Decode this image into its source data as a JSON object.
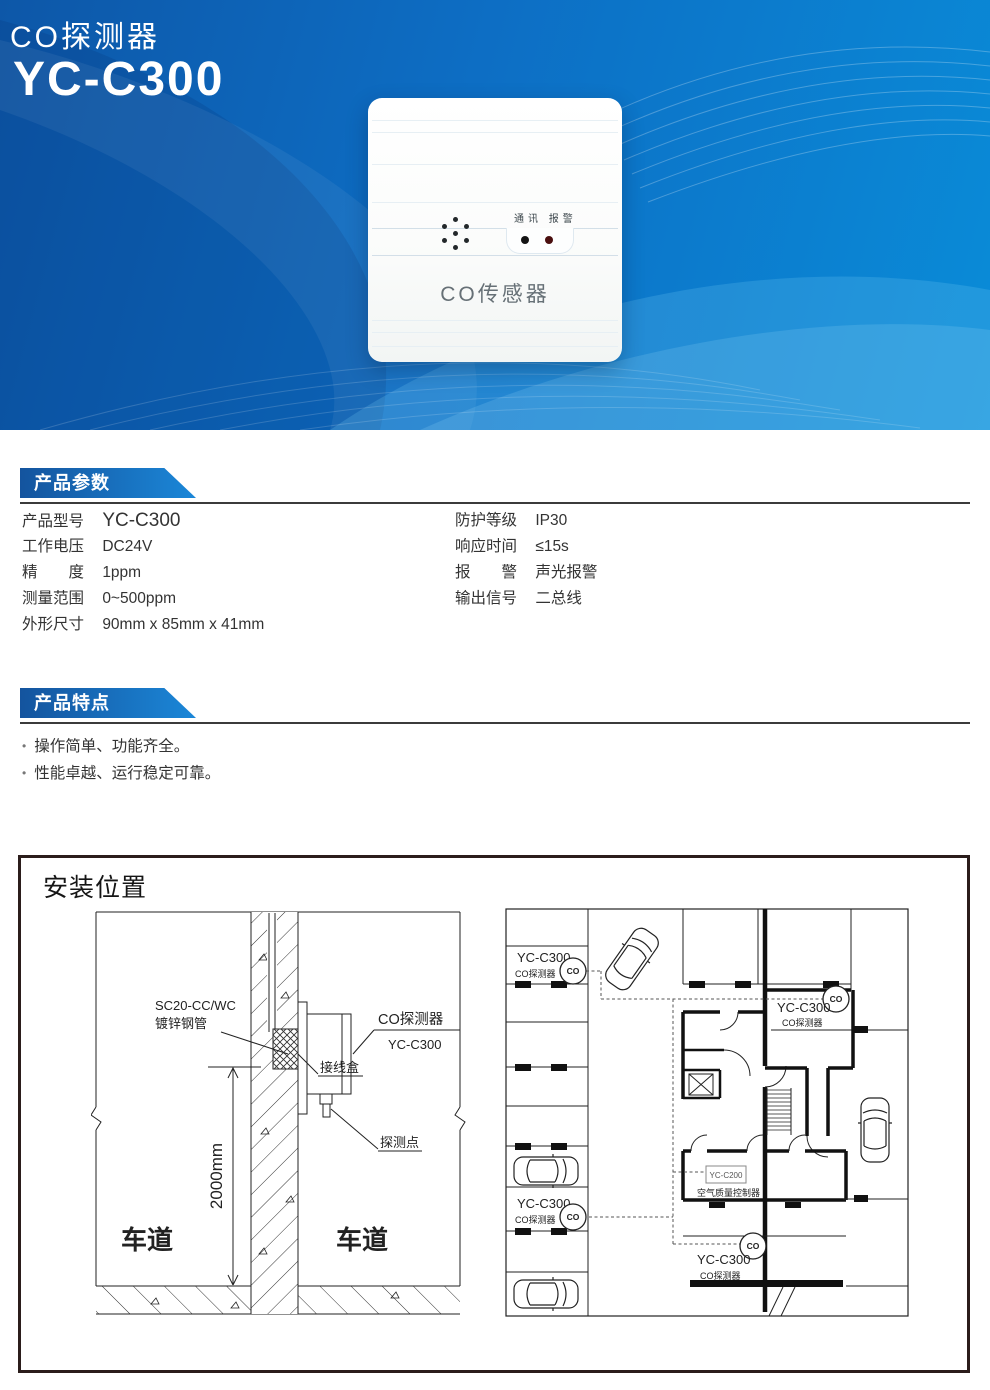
{
  "banner": {
    "category": "CO探测器",
    "model": "YC-C300",
    "bg_left": "#0d57a8",
    "bg_right": "#0a8cd8"
  },
  "device": {
    "led_label": "通讯 报警",
    "front_label": "CO传感器"
  },
  "params": {
    "title": "产品参数",
    "left": [
      {
        "label": "产品型号",
        "value": "YC-C300"
      },
      {
        "label": "工作电压",
        "value": "DC24V"
      },
      {
        "label": "精　　度",
        "value": "1ppm"
      },
      {
        "label": "测量范围",
        "value": "0~500ppm"
      },
      {
        "label": "外形尺寸",
        "value": "90mm x 85mm x 41mm"
      }
    ],
    "right": [
      {
        "label": "防护等级",
        "value": "IP30"
      },
      {
        "label": "响应时间",
        "value": "≤15s"
      },
      {
        "label": "报　　警",
        "value": "声光报警"
      },
      {
        "label": "输出信号",
        "value": "二总线"
      }
    ]
  },
  "features": {
    "title": "产品特点",
    "items": [
      "操作简单、功能齐全。",
      "性能卓越、运行稳定可靠。"
    ]
  },
  "installation": {
    "title": "安装位置",
    "wall": {
      "conduit_line1": "SC20-CC/WC",
      "conduit_line2": "镀锌钢管",
      "detector_name": "CO探测器",
      "detector_model": "YC-C300",
      "junction_box": "接线盒",
      "probe": "探测点",
      "height": "2000mm",
      "lane": "车道"
    },
    "plan": {
      "co": "CO",
      "detector_model": "YC-C300",
      "detector_name": "CO探测器",
      "controller_model": "YC-C200",
      "controller_name": "空气质量控制器"
    }
  }
}
